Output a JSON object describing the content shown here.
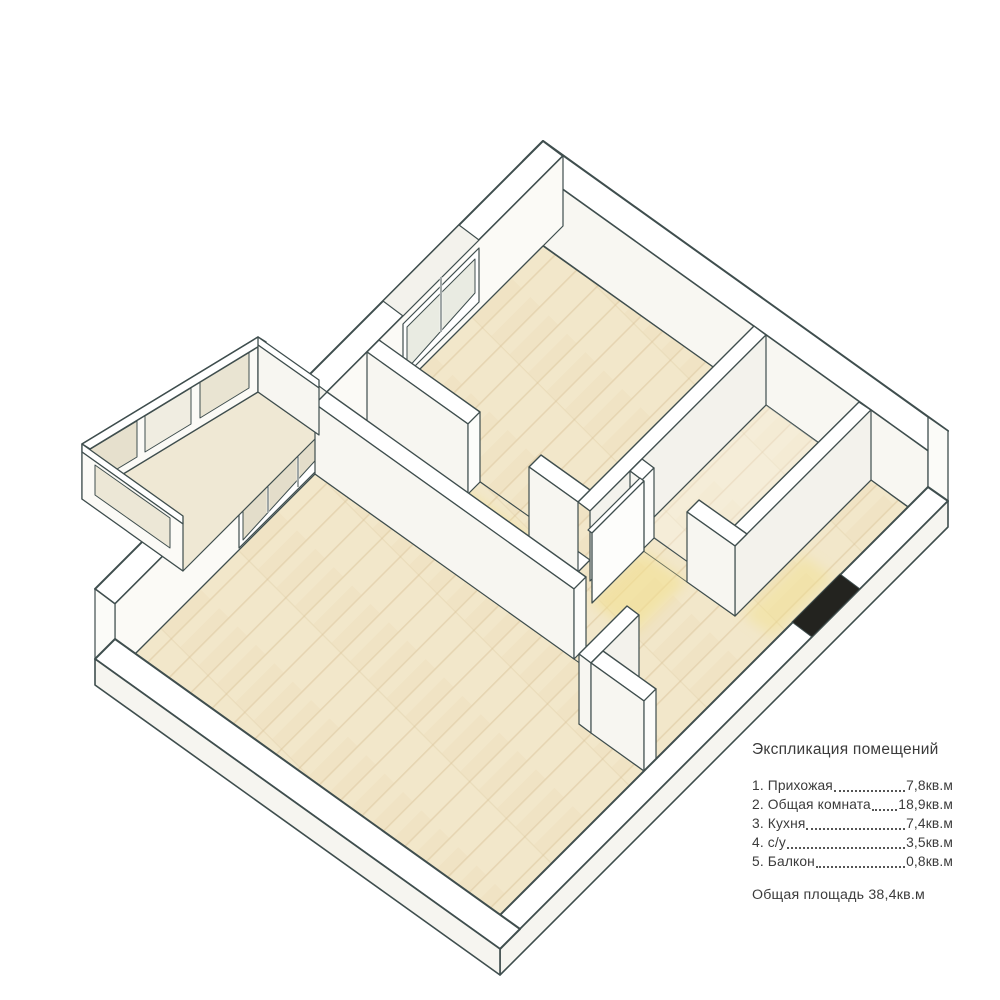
{
  "legend": {
    "title": "Экспликация помещений",
    "rooms": [
      {
        "name": "1. Прихожая",
        "area": "7,8кв.м"
      },
      {
        "name": "2. Общая комната",
        "area": "18,9кв.м"
      },
      {
        "name": "3. Кухня",
        "area": "7,4кв.м"
      },
      {
        "name": "4. с/у",
        "area": "3,5кв.м"
      },
      {
        "name": "5. Балкон",
        "area": "0,8кв.м"
      }
    ],
    "total": "Общая площадь 38,4кв.м"
  },
  "colors": {
    "outline": "#3f4e4e",
    "wall_top": "#ffffff",
    "wall_face": "#f3f2ec",
    "floor_wood": "#f2e7ca",
    "floor_seam": "#d9c49a",
    "light_glow": "#f2e08a",
    "glass": "#e9e4d2",
    "entrance_dark": "#23231f",
    "text": "#3b3b3b"
  }
}
